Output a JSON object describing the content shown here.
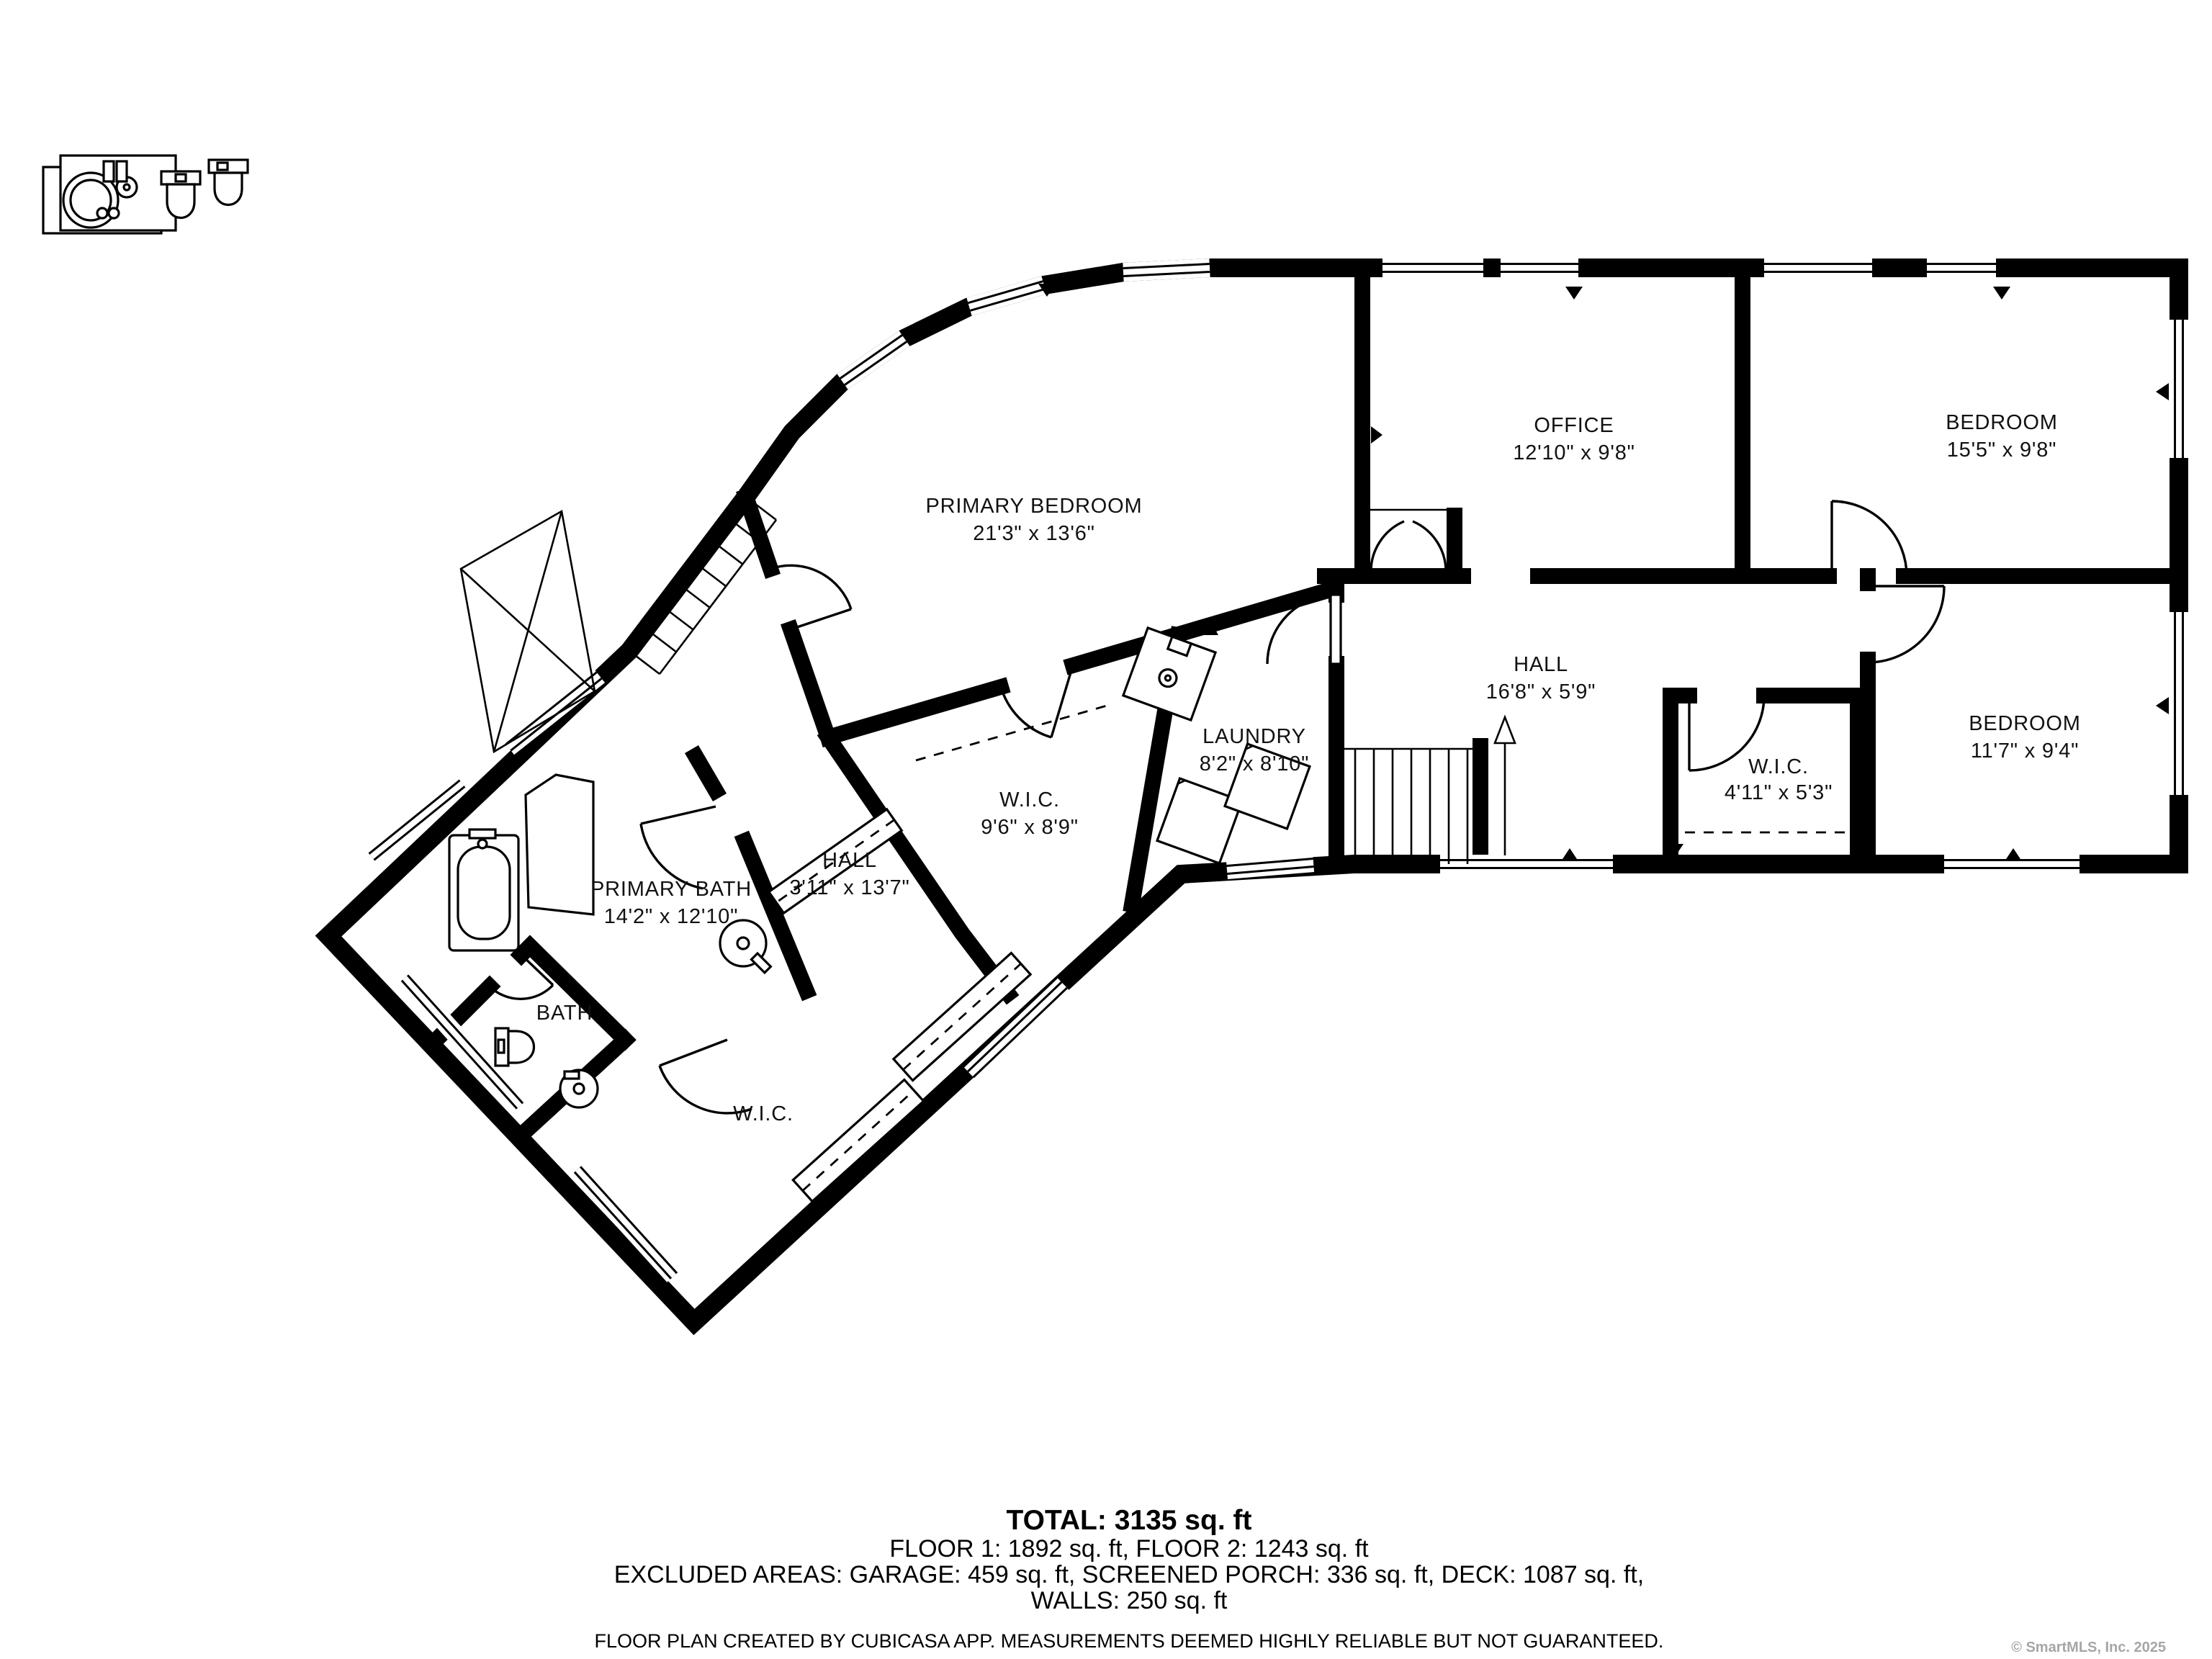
{
  "rooms": [
    {
      "name": "PRIMARY BEDROOM",
      "dims": "21'3\" x 13'6\""
    },
    {
      "name": "OFFICE",
      "dims": "12'10\" x 9'8\""
    },
    {
      "name": "BEDROOM",
      "dims": "15'5\" x 9'8\""
    },
    {
      "name": "HALL",
      "dims": "16'8\" x 5'9\""
    },
    {
      "name": "BEDROOM",
      "dims": "11'7\" x 9'4\""
    },
    {
      "name": "W.I.C.",
      "dims": "4'11\" x 5'3\""
    },
    {
      "name": "LAUNDRY",
      "dims": "8'2\" x 8'10\""
    },
    {
      "name": "W.I.C.",
      "dims": "9'6\" x 8'9\""
    },
    {
      "name": "HALL",
      "dims": "3'11\" x 13'7\""
    },
    {
      "name": "PRIMARY BATH",
      "dims": "14'2\" x 12'10\""
    },
    {
      "name": "BATH",
      "dims": ""
    },
    {
      "name": "W.I.C.",
      "dims": ""
    }
  ],
  "summary": {
    "total": "TOTAL: 3135 sq. ft",
    "floors": "FLOOR 1: 1892 sq. ft, FLOOR 2: 1243 sq. ft",
    "excluded": "EXCLUDED AREAS: GARAGE: 459 sq. ft, SCREENED PORCH: 336 sq. ft, DECK: 1087 sq. ft,",
    "walls": "WALLS: 250 sq. ft"
  },
  "disclaimer": "FLOOR PLAN CREATED BY CUBICASA APP. MEASUREMENTS DEEMED HIGHLY RELIABLE BUT NOT GUARANTEED.",
  "watermark": "© SmartMLS, Inc. 2025"
}
